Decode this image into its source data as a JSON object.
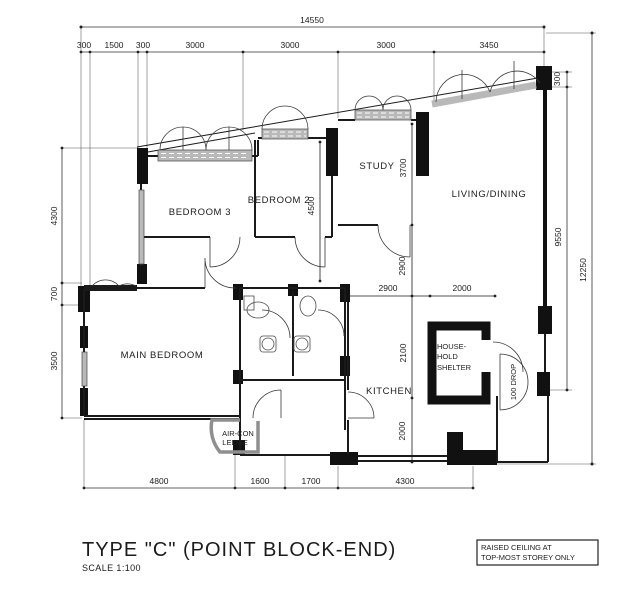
{
  "title": {
    "main": "TYPE \"C\" (POINT BLOCK-END)",
    "scale": "SCALE 1:100"
  },
  "note": {
    "line1": "RAISED CEILING AT",
    "line2": "TOP-MOST STOREY ONLY"
  },
  "rooms": {
    "bedroom3": "BEDROOM 3",
    "bedroom2": "BEDROOM 2",
    "study": "STUDY",
    "living_dining": "LIVING/DINING",
    "main_bedroom": "MAIN BEDROOM",
    "kitchen": "KITCHEN",
    "shelter_l1": "HOUSE-",
    "shelter_l2": "HOLD",
    "shelter_l3": "SHELTER",
    "aircon_l1": "AIR-CON",
    "aircon_l2": "LEDGE",
    "drop_label": "100 DROP"
  },
  "dimensions": {
    "top_total": "14550",
    "top_segments": [
      "300",
      "1500",
      "300",
      "3000",
      "3000",
      "3000",
      "3450"
    ],
    "right_step": "300",
    "right_inner": "9550",
    "right_outer": "12250",
    "left_segments": [
      "4300",
      "700",
      "3500"
    ],
    "bottom_segments": [
      "4800",
      "1600",
      "1700",
      "4300"
    ],
    "bedroom2_depth": "4500",
    "study_depth": "3700",
    "hall_depth": "2900",
    "kitchen_width": "2900",
    "shelter_width": "2000",
    "kitchen_depth": "2100",
    "yard_depth": "2000"
  }
}
